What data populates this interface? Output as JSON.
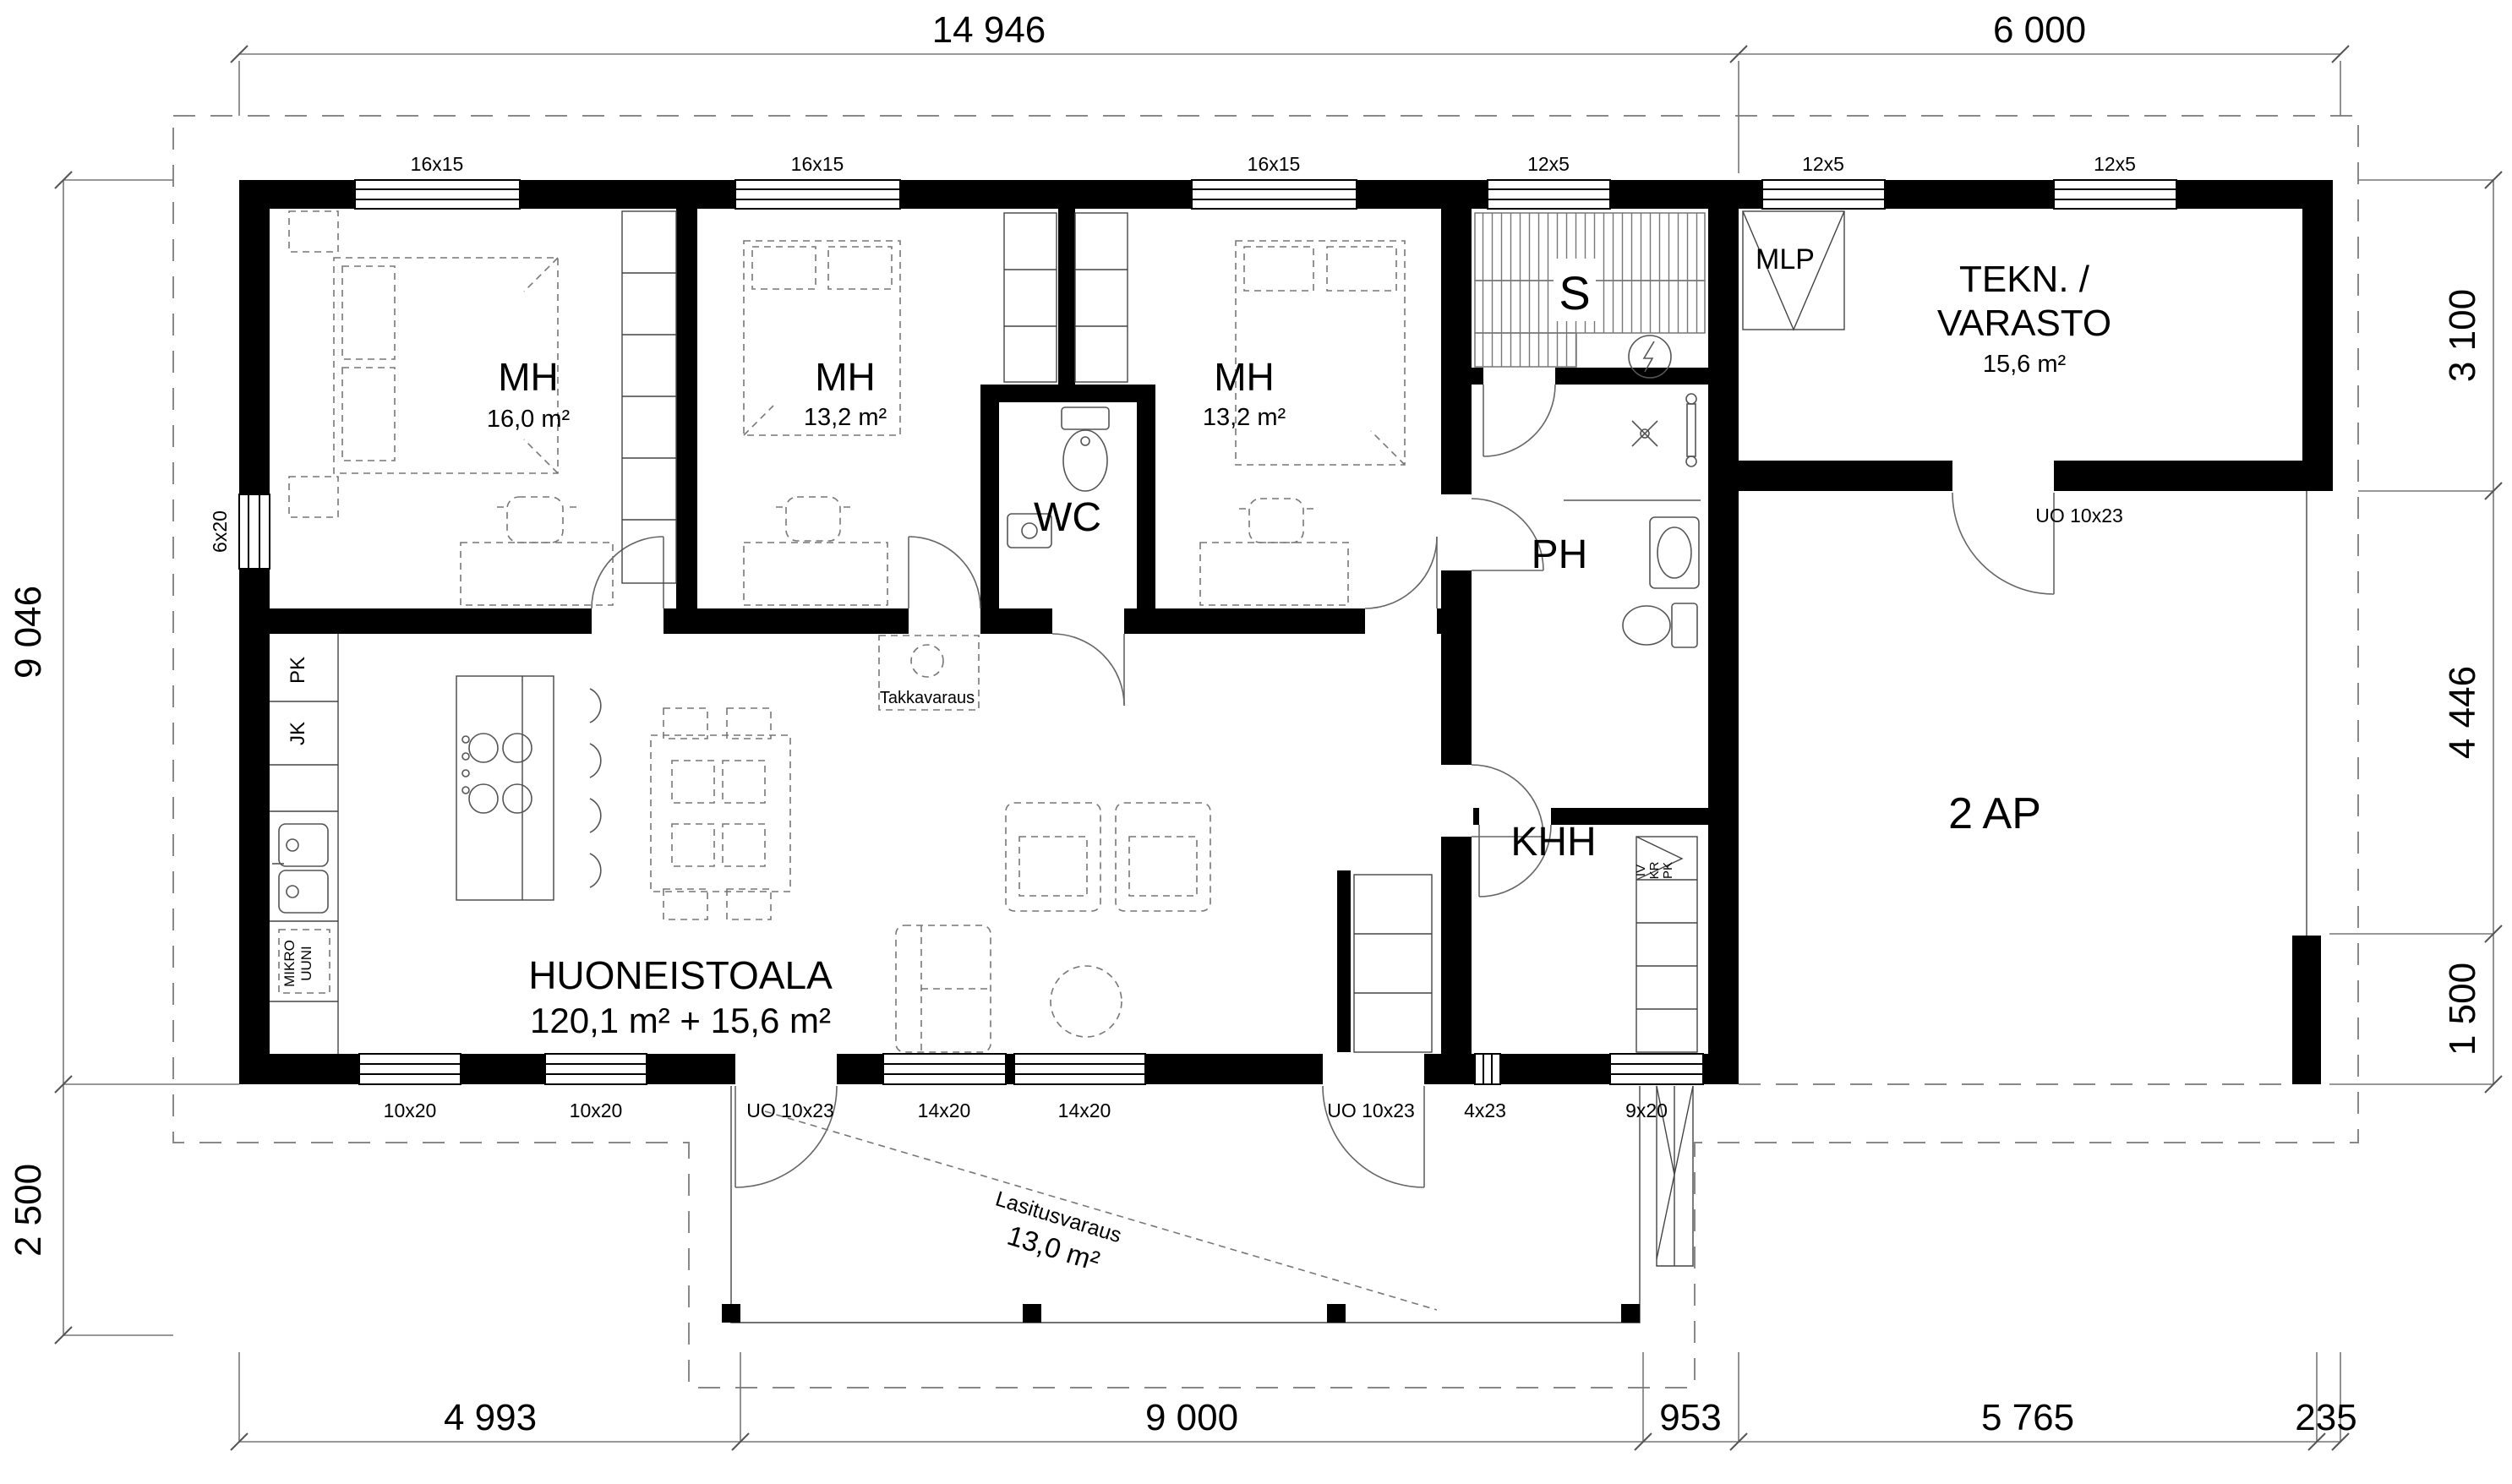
{
  "title": "Pohjapiirros (floor plan)",
  "dimensions": {
    "top": [
      "14 946",
      "6 000"
    ],
    "left": [
      "9 046",
      "2 500"
    ],
    "right": [
      "3 100",
      "4 446",
      "1 500"
    ],
    "bottom": [
      "4 993",
      "9 000",
      "953",
      "5 765",
      "235"
    ]
  },
  "windows": {
    "top": [
      "16x15",
      "16x15",
      "16x15",
      "12x5",
      "12x5",
      "12x5"
    ],
    "left": [
      "6x20"
    ],
    "bottom": [
      "10x20",
      "10x20",
      "UO 10x23",
      "14x20",
      "14x20",
      "UO 10x23",
      "4x23",
      "9x20"
    ],
    "tekn_door": "UO 10x23"
  },
  "rooms": {
    "mh1": {
      "name": "MH",
      "area": "16,0 m²"
    },
    "mh2": {
      "name": "MH",
      "area": "13,2 m²"
    },
    "mh3": {
      "name": "MH",
      "area": "13,2 m²"
    },
    "wc": {
      "name": "WC"
    },
    "sauna": {
      "name": "S"
    },
    "ph": {
      "name": "PH"
    },
    "khh": {
      "name": "KHH"
    },
    "mlp": {
      "name": "MLP"
    },
    "tekn": {
      "line1": "TEKN. /",
      "line2": "VARASTO",
      "area": "15,6 m²"
    },
    "carport": {
      "name": "2 AP"
    },
    "huoneistoala": {
      "line1": "HUONEISTOALA",
      "line2": "120,1 m² + 15,6 m²"
    }
  },
  "annotations": {
    "takkavaraus": "Takkavaraus",
    "lasitusvaraus": {
      "line1": "Lasitusvaraus",
      "line2": "13,0 m²"
    },
    "kitchen": {
      "pk": "PK",
      "jk": "JK",
      "mikro1": "MIKRO",
      "mikro2": "UUNI"
    },
    "khh_closet": {
      "l1": "IV",
      "l2": "KR",
      "l3": "PK"
    }
  }
}
